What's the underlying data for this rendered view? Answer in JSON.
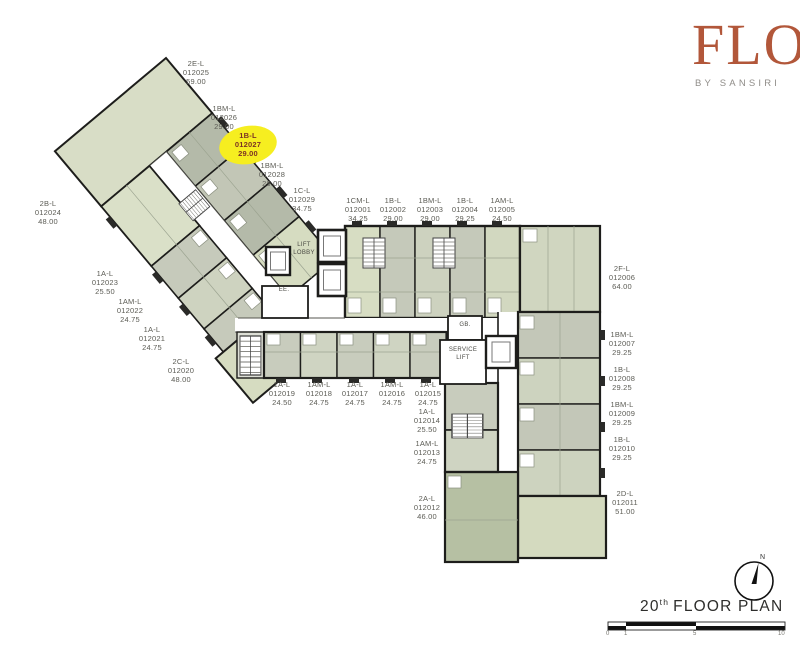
{
  "brand": {
    "name": "FLO",
    "tagline": "BY SANSIRI"
  },
  "plan_title": {
    "number": "20",
    "ordinal": "th",
    "text": "FLOOR PLAN"
  },
  "compass": {
    "north_label": "N"
  },
  "scale_bar": {
    "ticks": [
      "0",
      "1",
      "5",
      "10"
    ]
  },
  "core_labels": {
    "lift_lobby_line1": "LIFT",
    "lift_lobby_line2": "LOBBY",
    "ee": "EE.",
    "gb": "GB.",
    "service_lift_line1": "SERVICE",
    "service_lift_line2": "LIFT"
  },
  "highlight": {
    "unit_number": "012027",
    "color": "#f6ee20"
  },
  "colors": {
    "logo": "#b2573a",
    "wall": "#1d1d1b",
    "unit_green": "#d6dcc1",
    "unit_grey": "#c5c9ba",
    "unit_sage": "#b6c0a3"
  },
  "units": [
    {
      "type": "1CM-L",
      "number": "012001",
      "area": "34.25"
    },
    {
      "type": "1B-L",
      "number": "012002",
      "area": "29.00"
    },
    {
      "type": "1BM-L",
      "number": "012003",
      "area": "29.00"
    },
    {
      "type": "1B-L",
      "number": "012004",
      "area": "29.25"
    },
    {
      "type": "1AM-L",
      "number": "012005",
      "area": "24.50"
    },
    {
      "type": "2F-L",
      "number": "012006",
      "area": "64.00"
    },
    {
      "type": "1BM-L",
      "number": "012007",
      "area": "29.25"
    },
    {
      "type": "1B-L",
      "number": "012008",
      "area": "29.25"
    },
    {
      "type": "1BM-L",
      "number": "012009",
      "area": "29.25"
    },
    {
      "type": "1B-L",
      "number": "012010",
      "area": "29.25"
    },
    {
      "type": "2D-L",
      "number": "012011",
      "area": "51.00"
    },
    {
      "type": "2A-L",
      "number": "012012",
      "area": "46.00"
    },
    {
      "type": "1AM-L",
      "number": "012013",
      "area": "24.75"
    },
    {
      "type": "1A-L",
      "number": "012014",
      "area": "25.50"
    },
    {
      "type": "1A-L",
      "number": "012015",
      "area": "24.75"
    },
    {
      "type": "1AM-L",
      "number": "012016",
      "area": "24.75"
    },
    {
      "type": "1A-L",
      "number": "012017",
      "area": "24.75"
    },
    {
      "type": "1AM-L",
      "number": "012018",
      "area": "24.75"
    },
    {
      "type": "1A-L",
      "number": "012019",
      "area": "24.50"
    },
    {
      "type": "2C-L",
      "number": "012020",
      "area": "48.00"
    },
    {
      "type": "1A-L",
      "number": "012021",
      "area": "24.75"
    },
    {
      "type": "1AM-L",
      "number": "012022",
      "area": "24.75"
    },
    {
      "type": "1A-L",
      "number": "012023",
      "area": "25.50"
    },
    {
      "type": "2B-L",
      "number": "012024",
      "area": "48.00"
    },
    {
      "type": "2E-L",
      "number": "012025",
      "area": "59.00"
    },
    {
      "type": "1BM-L",
      "number": "012026",
      "area": "29.00"
    },
    {
      "type": "1B-L",
      "number": "012027",
      "area": "29.00"
    },
    {
      "type": "1BM-L",
      "number": "012028",
      "area": "29.00"
    },
    {
      "type": "1C-L",
      "number": "012029",
      "area": "34.75"
    }
  ]
}
